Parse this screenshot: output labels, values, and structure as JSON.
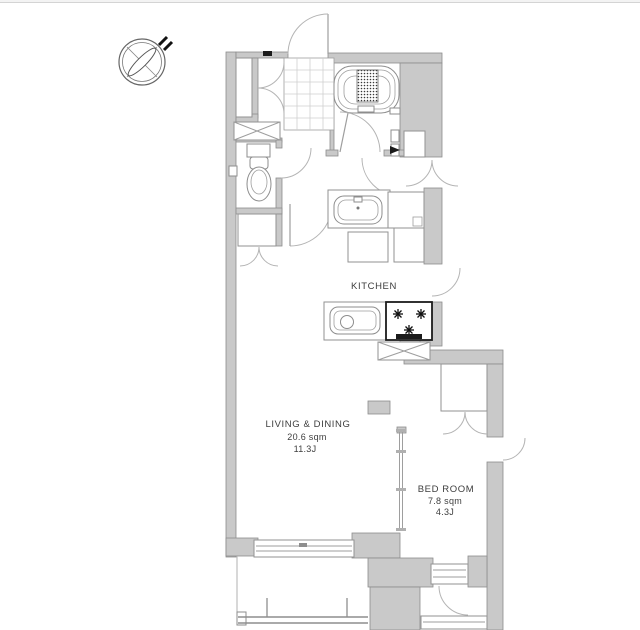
{
  "page": {
    "background": "#ffffff",
    "top_border_color": "#d4d4d4"
  },
  "floor_plan": {
    "compass": {
      "icon": "north-arrow-compass"
    },
    "labels": {
      "kitchen": {
        "name": "KITCHEN"
      },
      "living_dining": {
        "name": "LIVING & DINING",
        "area_sqm": "20.6 sqm",
        "area_tatami": "11.3J"
      },
      "bedroom": {
        "name": "BED ROOM",
        "area_sqm": "7.8 sqm",
        "area_tatami": "4.3J"
      }
    },
    "fixtures": [
      "bathtub",
      "bathroom-door",
      "toilet",
      "toilet-paper-holder",
      "washbasin",
      "washing-machine-pan",
      "refrigerator-space",
      "kitchen-sink",
      "gas-stove-3-burners",
      "pipe-shaft-crossed-box",
      "entrance-door",
      "genkan-tile",
      "shoe-cabinet",
      "hall-closet",
      "bedroom-closet",
      "sliding-partition",
      "service-doors",
      "balcony-railing",
      "sliding-window"
    ],
    "colors": {
      "wall_fill": "#c9c9c9",
      "wall_outline": "#8d8d8d",
      "line": "#9e9e9e",
      "door_arc": "#b4b4b4",
      "text": "#3d3d3d",
      "fixture_dark": "#1b1b1b"
    }
  }
}
